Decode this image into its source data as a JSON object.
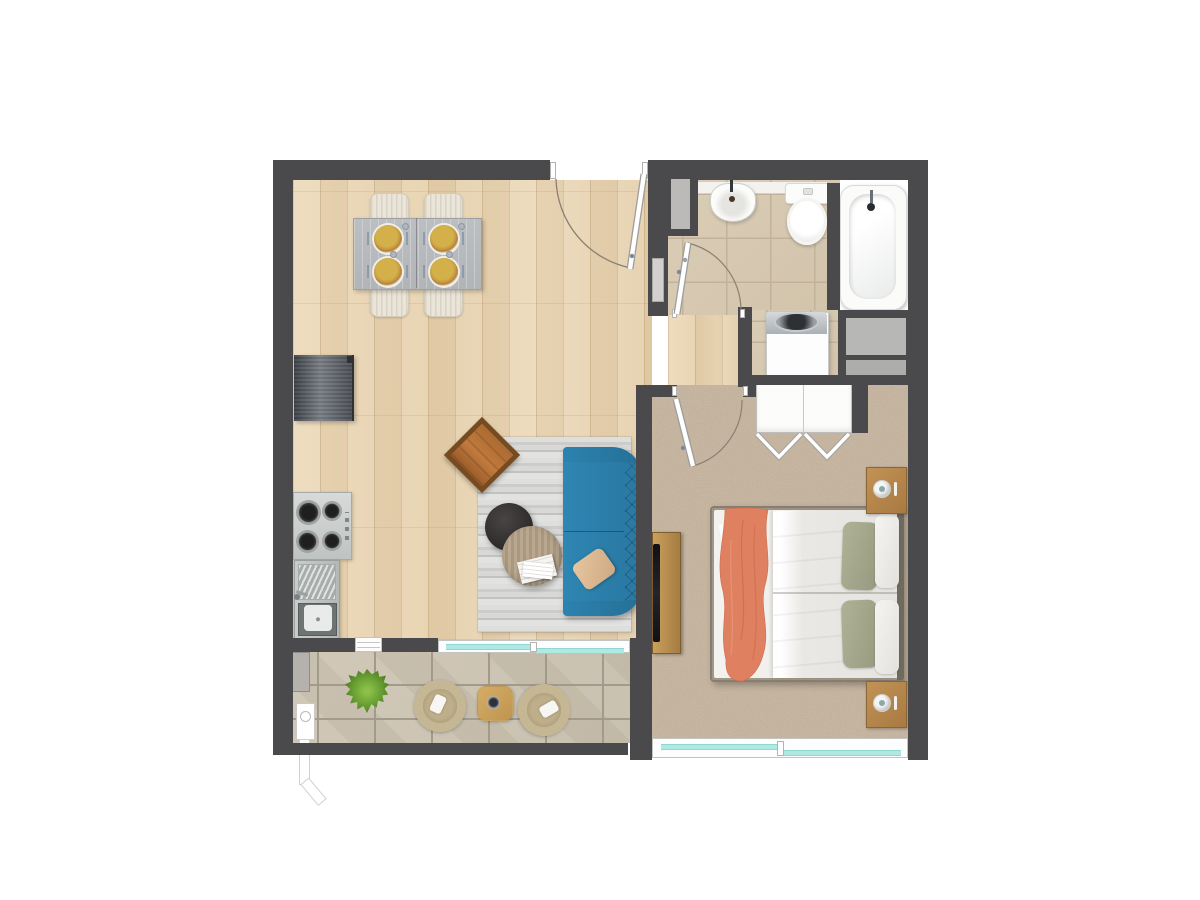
{
  "title": "Studio apartment floor plan (top-down 3D render)",
  "palette": {
    "wall": "#4a494b",
    "wood_floor": "#e8d4b4",
    "bathroom_tile": "#d6c8b1",
    "balcony_tile": "#cbc2b1",
    "carpet": "#c6b39b",
    "sofa_blue": "#2a7ca7",
    "blanket_coral": "#df8160",
    "leather_cognac": "#b26e38",
    "glass_cyan": "#aee9e4",
    "furniture_wood": "#b5854a",
    "fixture_white": "#fbfbfa"
  },
  "rooms": {
    "living": {
      "label": "Open-plan living and dining room with kitchenette",
      "floor": "light oak plank flooring"
    },
    "hallway": {
      "label": "Hallway",
      "floor": "light oak plank flooring"
    },
    "bathroom": {
      "label": "Bathroom with laundry nook",
      "floor": "beige ceramic tile"
    },
    "bedroom": {
      "label": "Bedroom",
      "floor": "beige carpet"
    },
    "balcony": {
      "label": "Balcony terrace",
      "floor": "stone tile"
    }
  },
  "furniture": {
    "dining_table": "Dining table with four place settings",
    "dining_chair": "Upholstered dining chair",
    "fridge": "Refrigerator",
    "cooktop": "Four-burner gas cooktop",
    "kitchen_sink": "Kitchen sink with drainboard",
    "rug": "Striped grey area rug",
    "sofa": "Blue three-seat tufted sofa",
    "sofa_pillow": "Beige throw pillow",
    "lounge_chair": "Cognac leather butterfly chair",
    "coffee_table": "Round dark coffee table",
    "side_table": "Round wooden side table with magazines",
    "tv_console": "TV sideboard",
    "tv": "Flat-screen television",
    "bed": "Double bed with white duvet",
    "blanket": "Coral throw blanket",
    "green_pillow": "Sage green pillow",
    "white_pillow": "White pillow",
    "book": "Open book",
    "tray": "Breakfast tray with cup",
    "nightstand": "Wooden nightstand with table lamp",
    "wardrobe": "Built-in wardrobe with bi-fold doors",
    "basin": "Wash basin",
    "toilet": "Toilet",
    "bathtub": "Bathtub",
    "washing_machine": "Top-load washing machine",
    "shelves": "Recessed storage shelves",
    "shaft": "Service shaft",
    "wall_cabinet": "Wall cabinet",
    "plant": "Potted grass plant",
    "patio_chair": "Round wicker lounge chair",
    "patio_table": "Square patio side table",
    "utility_box": "Utility box",
    "downpipe": "Rain water downpipe"
  },
  "openings": {
    "entrance_door": "Entrance door opening into living room",
    "bathroom_door": "Bathroom door",
    "bedroom_door": "Bedroom door",
    "balcony_slider": "Sliding glass door to balcony",
    "kitchen_window": "Kitchen pass-through window",
    "bedroom_window": "Bedroom sliding window"
  }
}
